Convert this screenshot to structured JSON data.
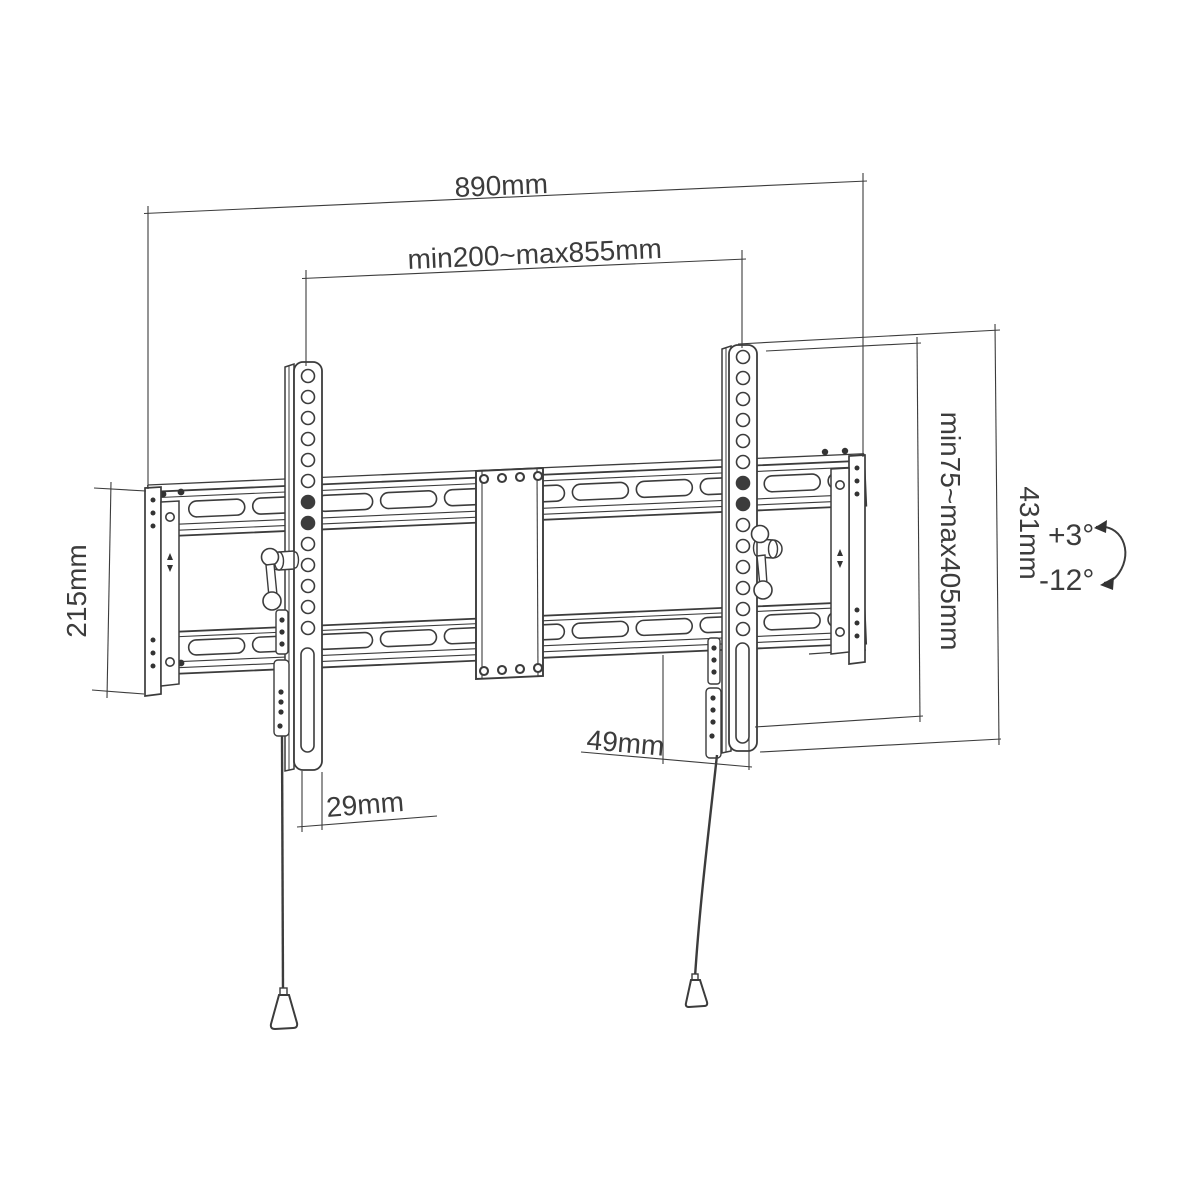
{
  "page": {
    "background": "#ffffff"
  },
  "drawing": {
    "subject": "tilting-tv-wall-mount-dimension-drawing",
    "line_color": "#3c3c3c",
    "labels": {
      "overall_width": "890mm",
      "horizontal_adjust_range": "min200~max855mm",
      "wall_plate_height": "215mm",
      "vertical_adjust_range": "min75~max405mm",
      "bracket_height": "431mm",
      "right_bottom_offset": "49mm",
      "left_bottom_offset": "29mm",
      "tilt_up": "+3°",
      "tilt_down": "-12°"
    }
  }
}
